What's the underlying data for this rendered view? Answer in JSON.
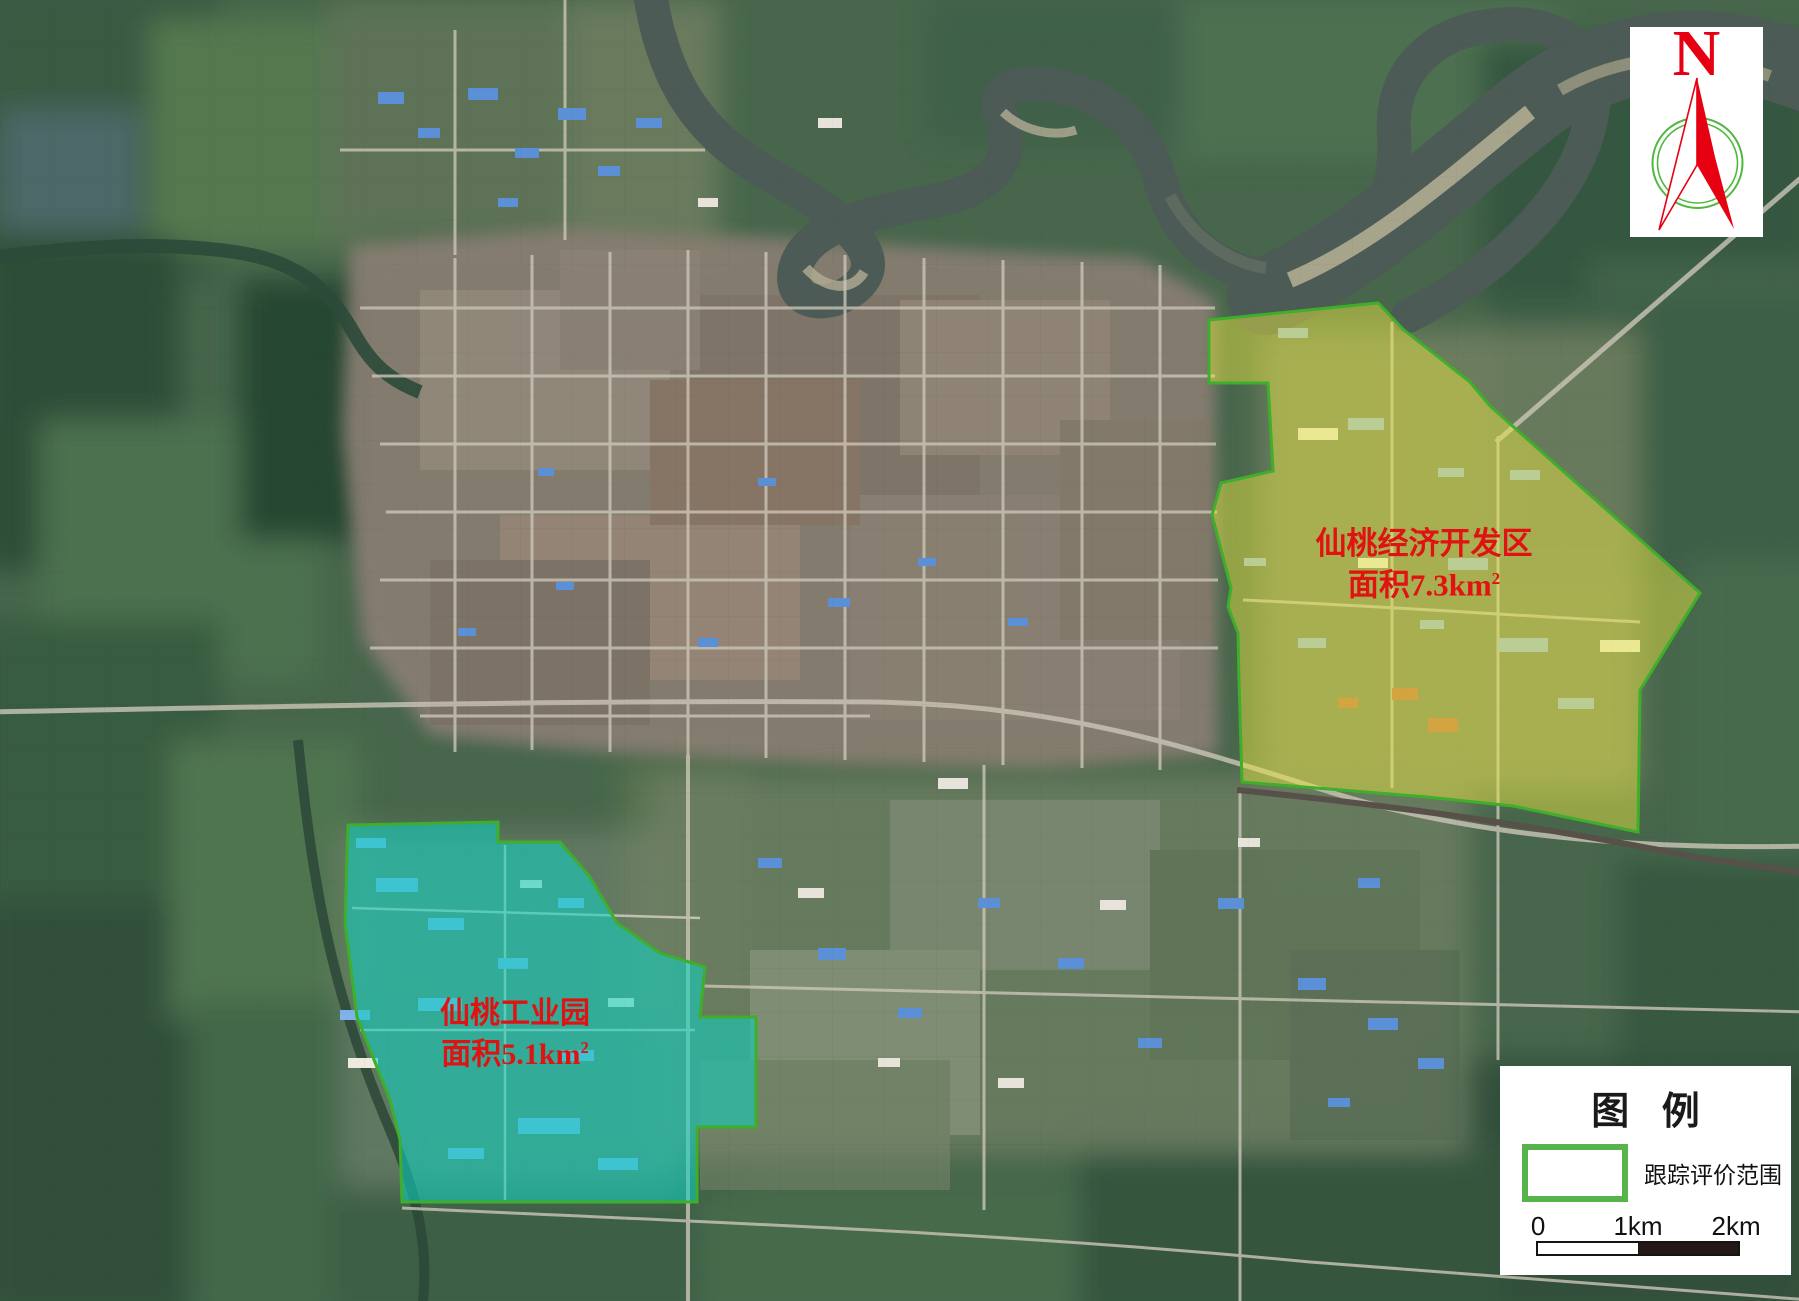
{
  "map": {
    "zones": [
      {
        "id": "economic-development-zone",
        "name": "仙桃经济开发区",
        "area_label": "面积7.3km",
        "area_superscript": "2",
        "fill_color": "#e8e542",
        "border_color": "#3fae2a"
      },
      {
        "id": "industrial-park",
        "name": "仙桃工业园",
        "area_label": "面积5.1km",
        "area_superscript": "2",
        "fill_color": "#0fd0c0",
        "border_color": "#3fae2a"
      }
    ],
    "zone_label_color": "#e01212"
  },
  "north_arrow": {
    "letter": "N",
    "needle_color": "#e60012",
    "ring_color": "#4fb83e"
  },
  "legend": {
    "title": "图 例",
    "items": [
      {
        "label": "跟踪评价范围",
        "swatch_border_color": "#56b44b"
      }
    ],
    "scale_bar": {
      "ticks": [
        "0",
        "1km",
        "2km"
      ],
      "dark_color": "#231815"
    }
  }
}
